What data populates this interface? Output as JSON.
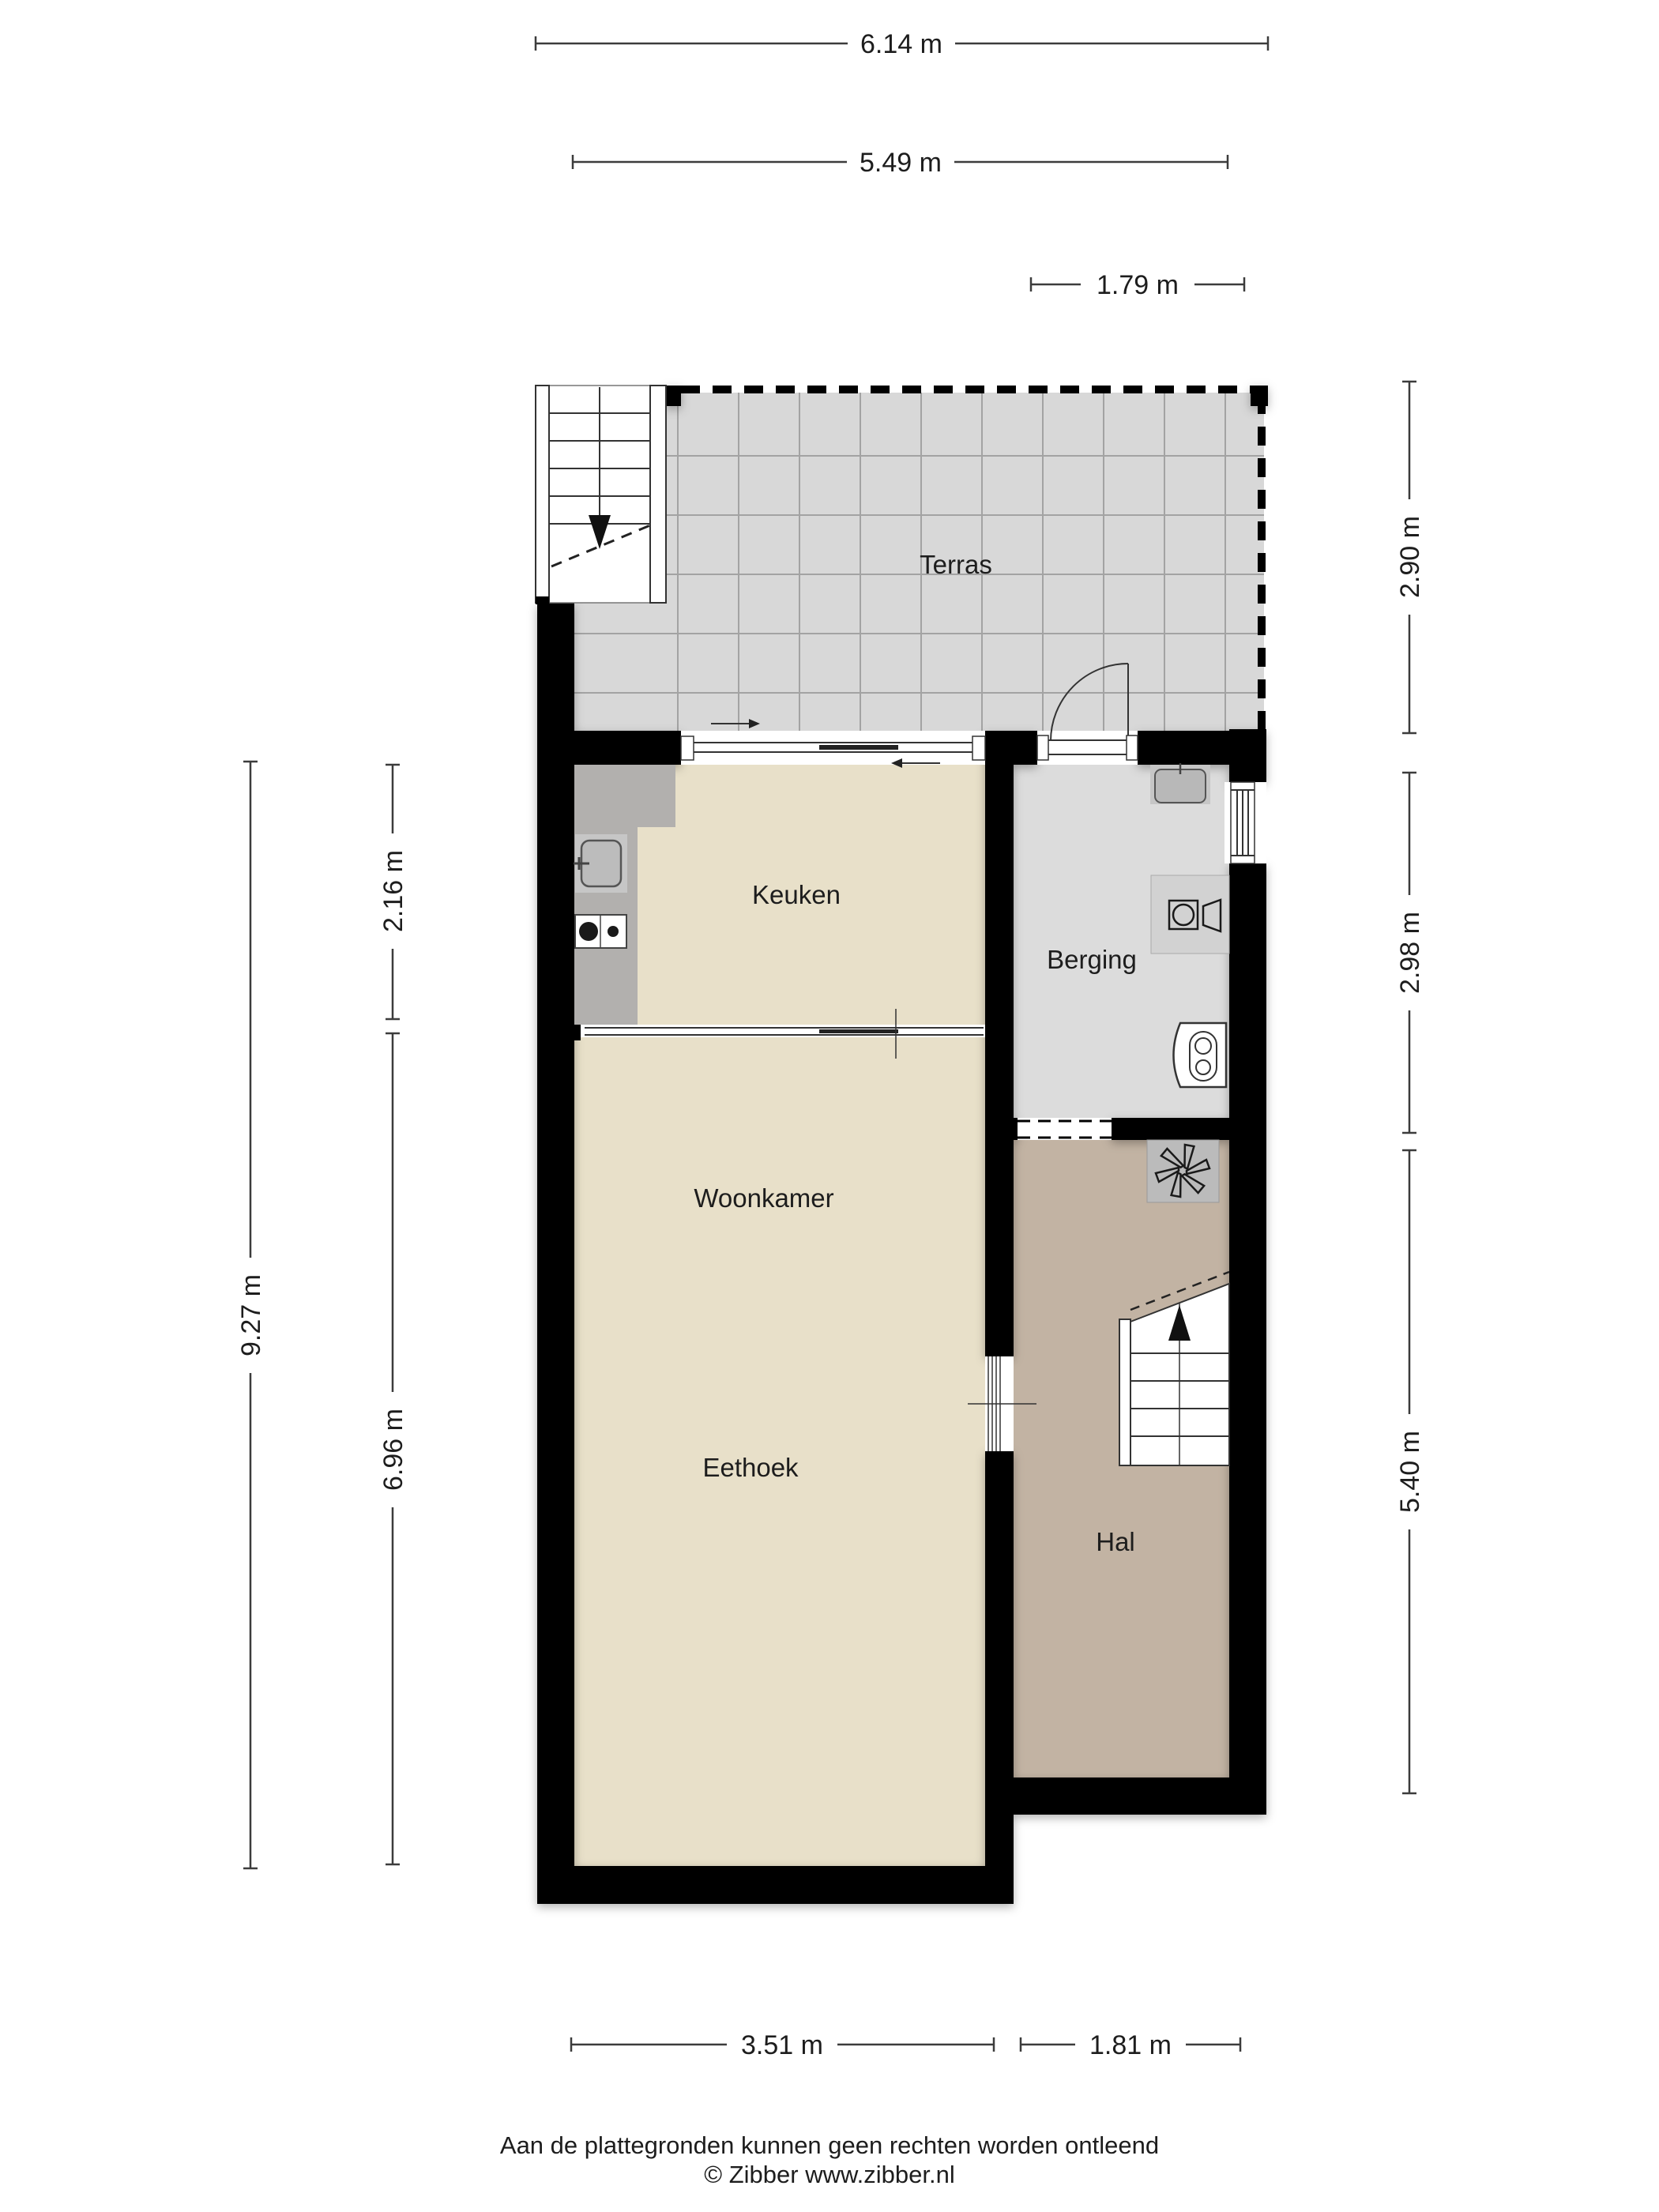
{
  "rooms": {
    "terras": {
      "label": "Terras"
    },
    "keuken": {
      "label": "Keuken"
    },
    "berging": {
      "label": "Berging"
    },
    "woonkamer": {
      "label": "Woonkamer"
    },
    "eethoek": {
      "label": "Eethoek"
    },
    "hal": {
      "label": "Hal"
    }
  },
  "dimensions": {
    "total_width": "6.14 m",
    "inner_width": "5.49 m",
    "berging_width_top": "1.79 m",
    "terras_height": "2.90 m",
    "berging_height": "2.98 m",
    "hal_height": "5.40 m",
    "left_total_height": "9.27 m",
    "keuken_height": "2.16 m",
    "woonkamer_height": "6.96 m",
    "eethoek_width": "3.51 m",
    "hal_width": "1.81 m"
  },
  "footer": {
    "disclaimer": "Aan de plattegronden kunnen geen rechten worden ontleend",
    "copyright": "© Zibber www.zibber.nl"
  },
  "colors": {
    "wall": "#000000",
    "floor_living": "#e8e0c9",
    "floor_hal": "#c2b3a3",
    "floor_berging": "#dcdcdc",
    "floor_terras": "#d8d8d8",
    "tile_line": "#a3a3a3",
    "counter": "#b2b0ae",
    "fixture_gray": "#c6c6c6",
    "dim_line": "#3c3c3c",
    "text": "#1d1d1d"
  }
}
